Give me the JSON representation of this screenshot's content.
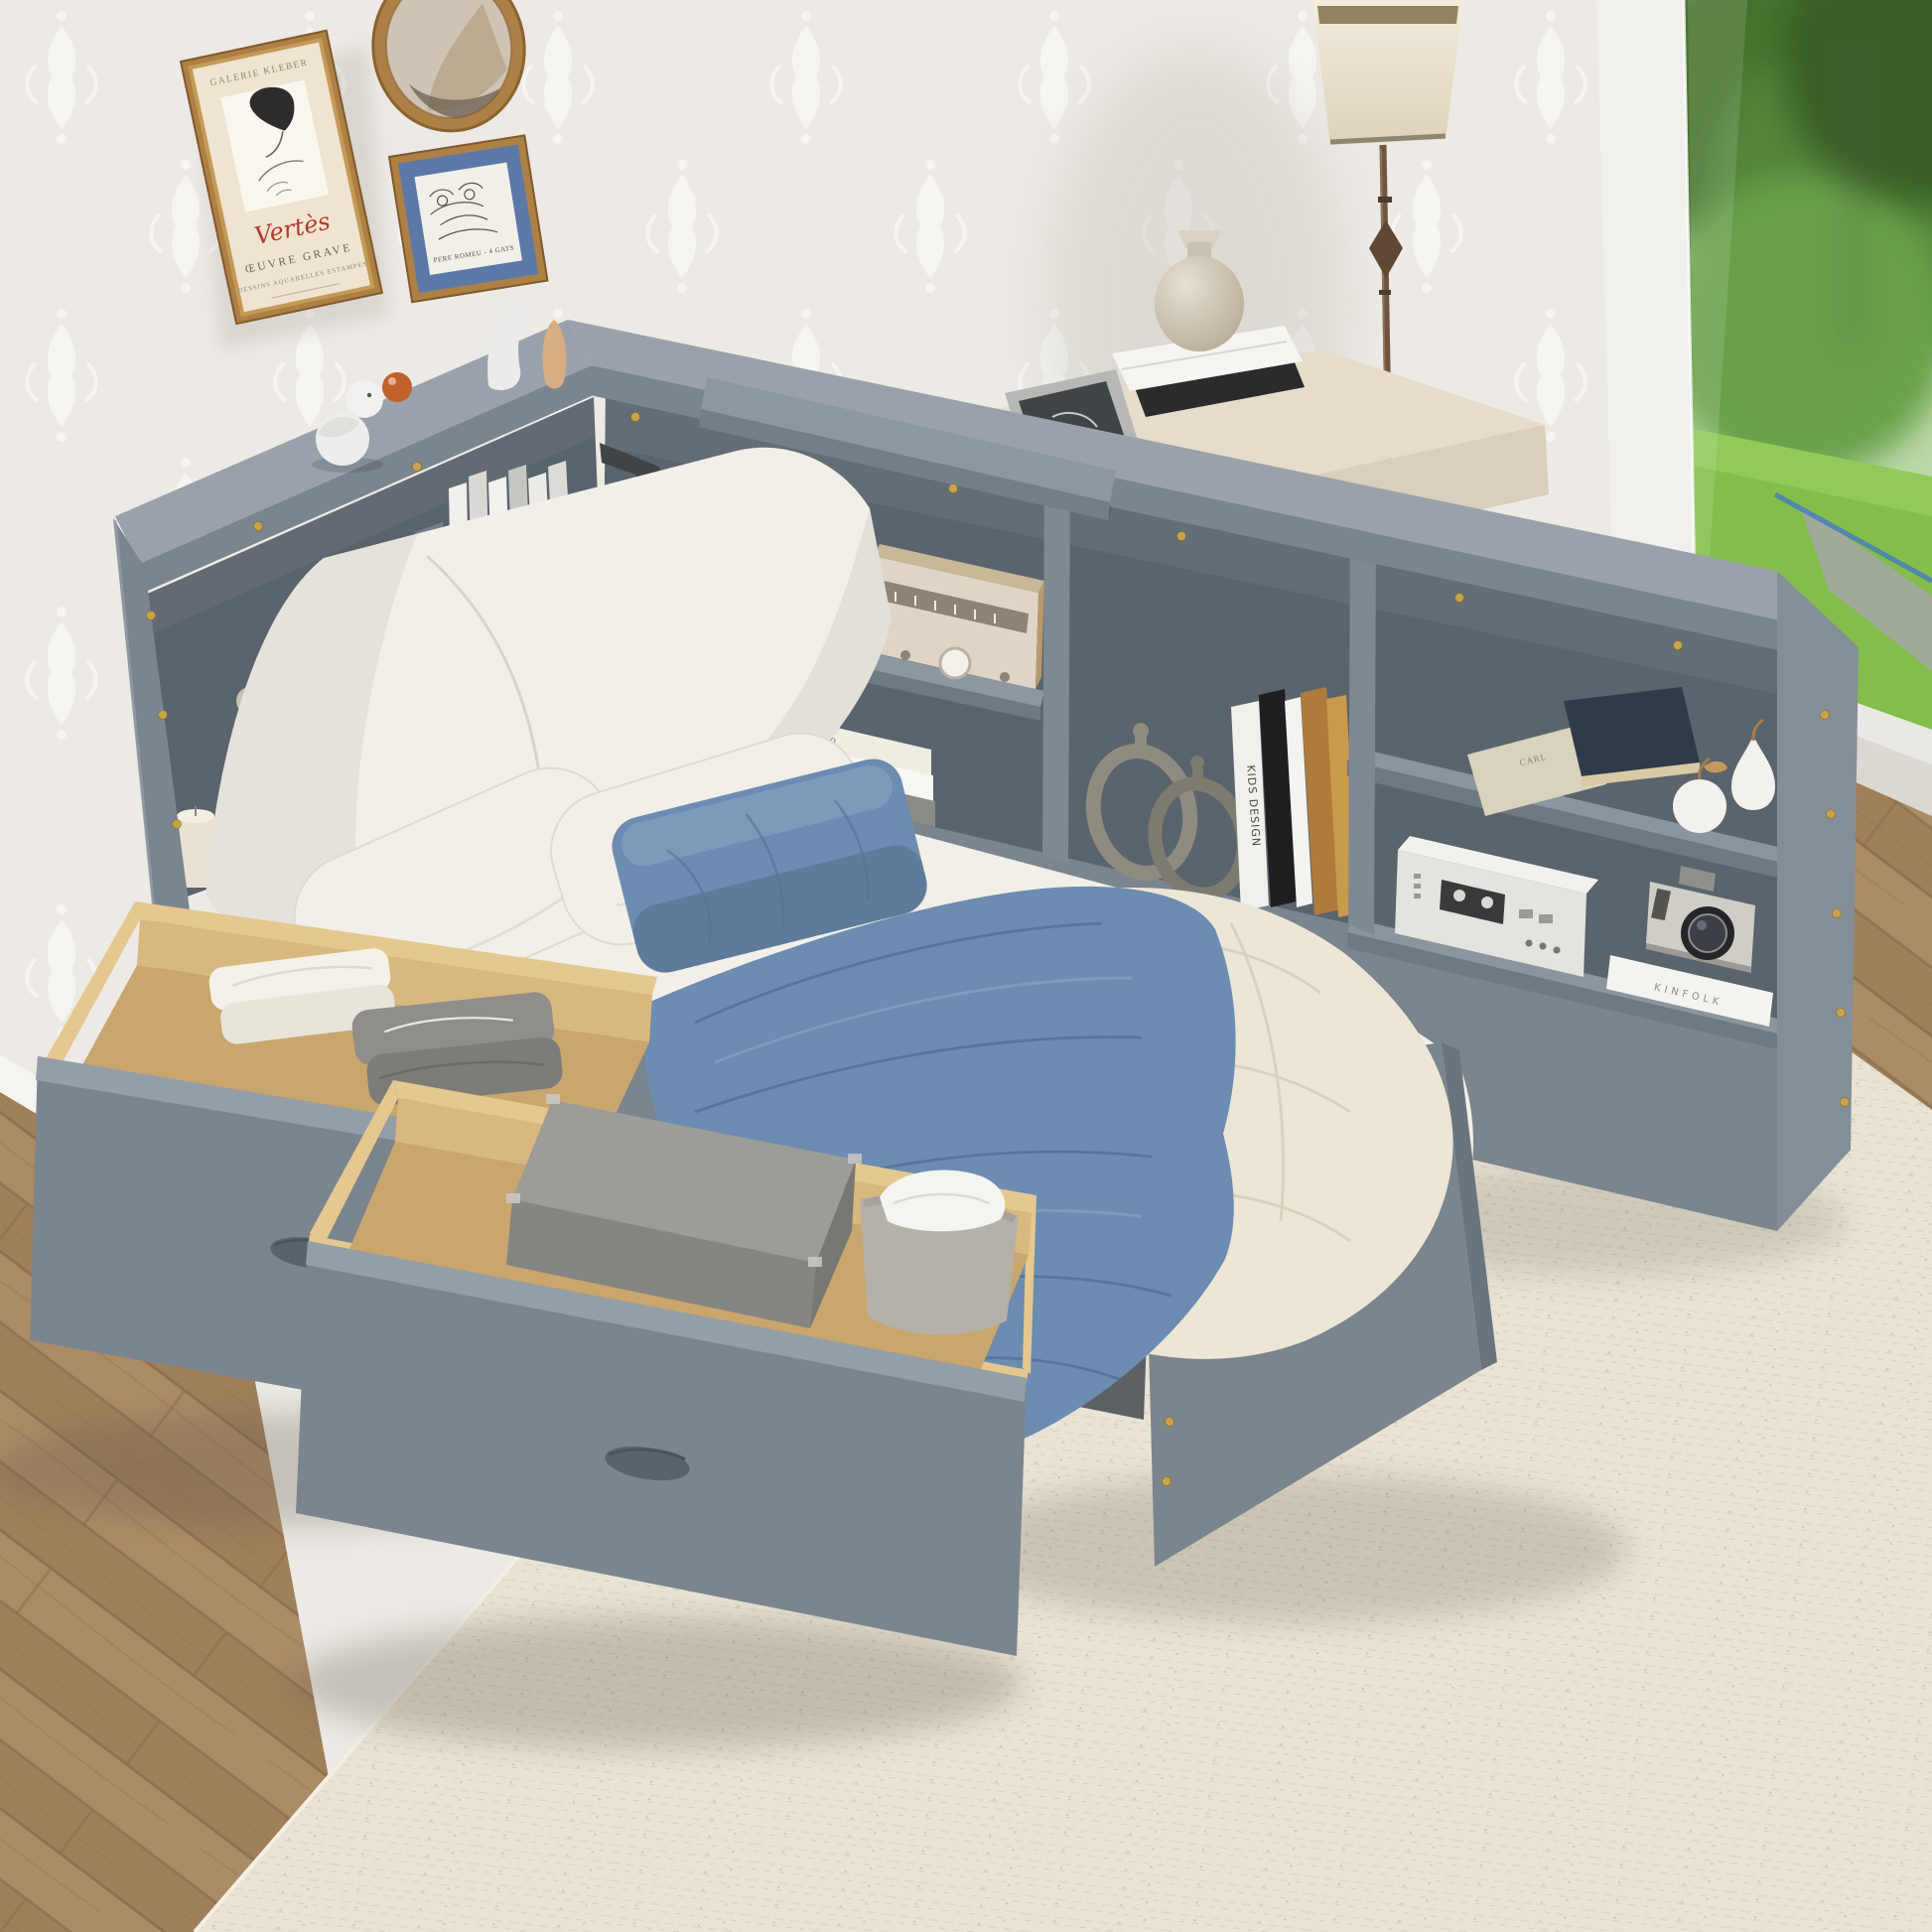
{
  "artwork": {
    "poster_galerie": {
      "gallery": "GALERIE  KLEBER",
      "signature": "Vertès",
      "title": "ŒUVRE  GRAVE",
      "subtitle": "DESSINS  AQUARELLES  ESTAMPES"
    },
    "poster_cats": {
      "caption": "PERE ROMEU - 4 GATS"
    }
  },
  "books": {
    "spine_top": "TAGAS ANGO",
    "spine_bottom": "BRINGING THE HOUSE HOME",
    "spine_kids": "KIDS DESIGN",
    "cover_kinfolk": "KINFOLK",
    "cover_carl": "CARL"
  },
  "colors": {
    "wall": "#edeae5",
    "bed_gray": "#7b858e",
    "bed_gray_top": "#99a2aa",
    "bed_gray_dark": "#5a646d",
    "drawer_wood": "#e4c88f",
    "textile_blue": "#6d8cb1",
    "linen_white": "#f2efe8",
    "duvet_cream": "#ece6d7",
    "wood_floor": "#a9875f",
    "rug": "#e9e3d5",
    "frame_gold": "#ad8045",
    "grass_green": "#83bd4b",
    "accent_orange": "#c2602a",
    "brass_screw": "#c9a24a"
  }
}
